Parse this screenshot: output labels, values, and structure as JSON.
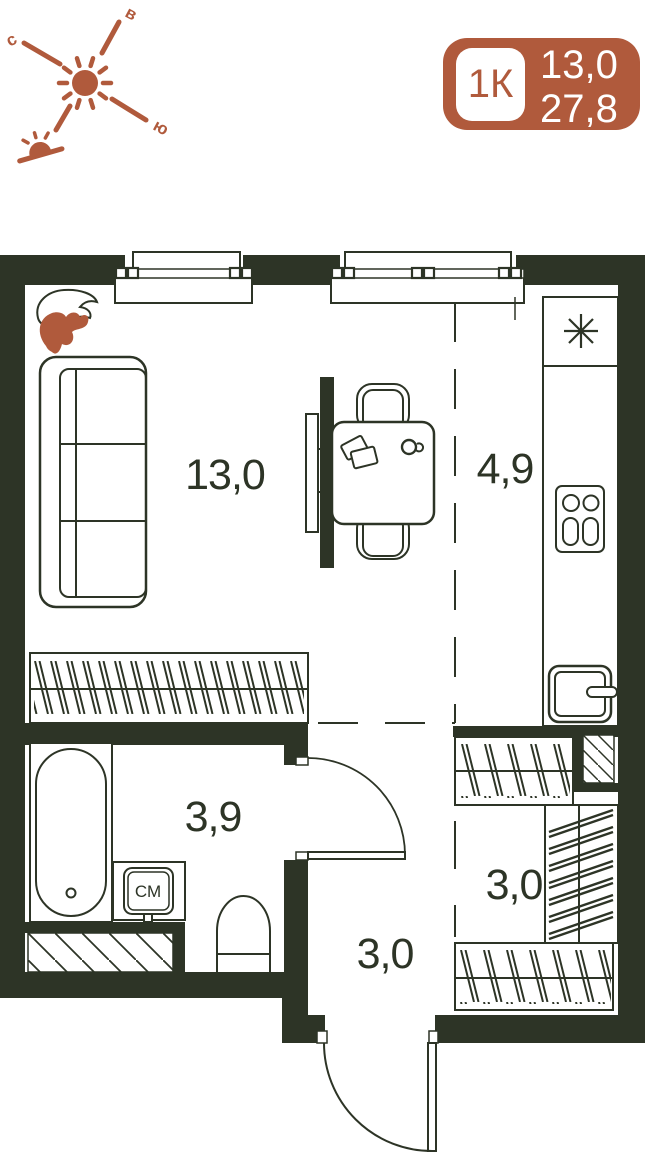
{
  "badge": {
    "unit_type": "1К",
    "area_living": "13,0",
    "area_total": "27,8"
  },
  "compass": {
    "north": "с",
    "east": "в",
    "south": "ю"
  },
  "rooms": {
    "living": "13,0",
    "kitchen": "4,9",
    "bathroom": "3,9",
    "hallway": "3,0",
    "wardrobe": "3,0"
  },
  "appliances": {
    "washing_machine": "СМ"
  },
  "colors": {
    "ink": "#2d3426",
    "accent": "#b05a3c",
    "paper": "#ffffff"
  }
}
